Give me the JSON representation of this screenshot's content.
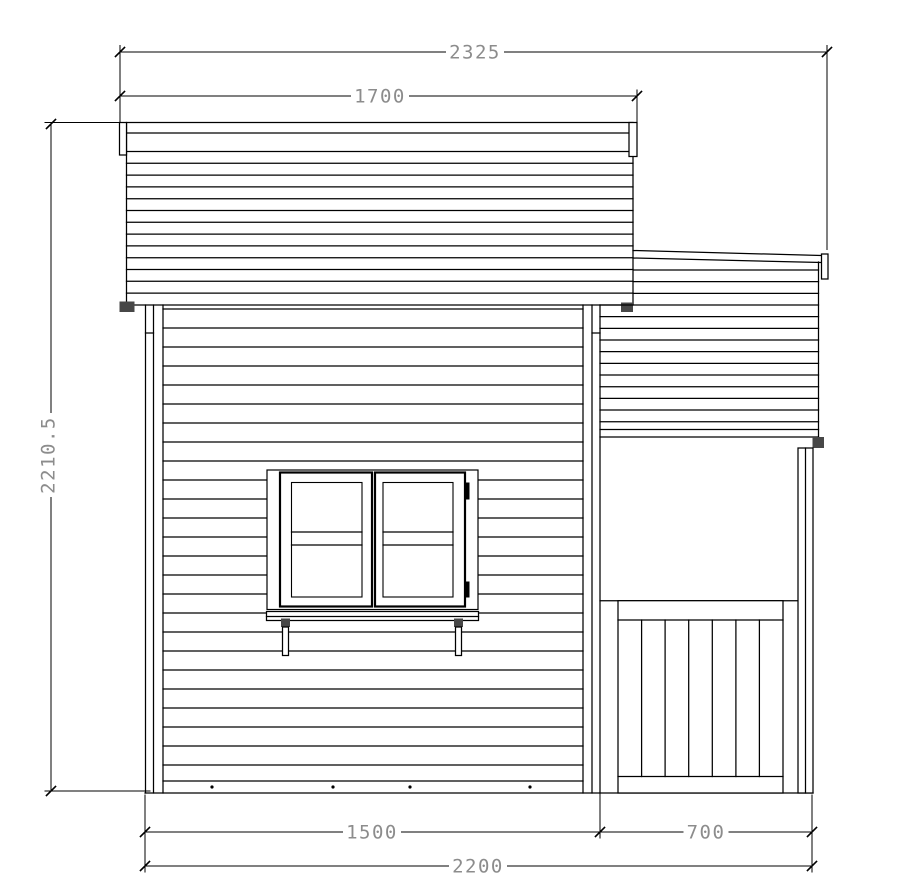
{
  "drawing": {
    "description": "playhouse-side-elevation",
    "canvas": {
      "w": 921,
      "h": 891,
      "background": "#ffffff",
      "line_color": "#000000",
      "dim_text_color": "#8c8c8c",
      "hatch_color": "#474747"
    },
    "groups": [
      {
        "name": "main-roof",
        "prims": [
          {
            "t": "r",
            "n": "main-roof-panel",
            "p": [
              126.5,
              122.5,
              506.5,
              182.5
            ]
          },
          {
            "t": "l",
            "n": "main-roof-fascia-line",
            "p": [
              126.5,
              133,
              633,
              133
            ]
          },
          {
            "t": "hl",
            "n": "main-roof-board-line",
            "y0": 151.5,
            "step": 11.8,
            "count": 13,
            "x1": 126.5,
            "x2": 633
          },
          {
            "t": "r",
            "n": "main-roof-left-trim",
            "p": [
              119.5,
              122.5,
              7,
              32.5
            ]
          },
          {
            "t": "r",
            "n": "main-roof-right-trim",
            "p": [
              629,
              122.5,
              8,
              34
            ]
          },
          {
            "t": "h",
            "n": "roof-eave-block-left",
            "p": [
              119.5,
              301.5,
              15,
              10.5
            ]
          },
          {
            "t": "h",
            "n": "roof-eave-block-right",
            "p": [
              621,
              302.5,
              12,
              9.5
            ]
          }
        ]
      },
      {
        "name": "porch-roof",
        "prims": [
          {
            "t": "l",
            "n": "porch-roof-top-edge",
            "p": [
              633,
              250.5,
              821,
              255.5
            ]
          },
          {
            "t": "l",
            "n": "porch-roof-fascia-line",
            "p": [
              633,
              258,
              821,
              262.5
            ]
          },
          {
            "t": "l",
            "n": "porch-roof-right-edge",
            "p": [
              818.5,
              262,
              818.5,
              437
            ]
          },
          {
            "t": "hl",
            "n": "porch-roof-board-line",
            "y0": 270,
            "step": 11.67,
            "count": 3,
            "x1": 633.5,
            "x2": 818.5
          },
          {
            "t": "hl",
            "n": "porch-roof-board-line",
            "y0": 305,
            "step": 11.67,
            "count": 11,
            "x1": 600,
            "x2": 818.5
          },
          {
            "t": "l",
            "n": "porch-roof-band-line",
            "p": [
              600,
              429.5,
              818.5,
              429.5
            ]
          },
          {
            "t": "l",
            "n": "porch-roof-bottom-edge",
            "p": [
              600,
              437,
              818.5,
              437
            ]
          },
          {
            "t": "r",
            "n": "porch-roof-right-trim",
            "p": [
              821.5,
              254,
              6.5,
              25
            ]
          },
          {
            "t": "h",
            "n": "porch-roof-corner-block",
            "p": [
              812.5,
              437,
              11.5,
              11
            ]
          }
        ]
      },
      {
        "name": "main-wall",
        "prims": [
          {
            "t": "l",
            "n": "left-corner-trim-outer",
            "p": [
              145.5,
              305,
              145.5,
              793
            ]
          },
          {
            "t": "l",
            "n": "left-corner-trim-inner",
            "p": [
              153.5,
              305,
              153.5,
              793
            ]
          },
          {
            "t": "l",
            "n": "left-corner-trim-edge",
            "p": [
              163,
              305,
              163,
              793
            ]
          },
          {
            "t": "l",
            "n": "left-corner-plate-tick",
            "p": [
              145.5,
              333,
              153.5,
              333
            ]
          },
          {
            "t": "l",
            "n": "right-corner-trim-edge",
            "p": [
              583,
              305,
              583,
              793
            ]
          },
          {
            "t": "l",
            "n": "right-corner-trim-inner",
            "p": [
              592,
              305,
              592,
              793
            ]
          },
          {
            "t": "l",
            "n": "right-corner-trim-outer",
            "p": [
              600,
              305,
              600,
              793
            ]
          },
          {
            "t": "l",
            "n": "right-corner-plate-tick",
            "p": [
              592,
              333,
              600,
              333
            ]
          },
          {
            "t": "hl",
            "n": "wall-siding-board-line",
            "y0": 309,
            "step": 19,
            "count": 24,
            "x1": 163,
            "x2": 583
          },
          {
            "t": "l",
            "n": "skirt-top-line",
            "p": [
              163,
              765,
              583,
              765
            ]
          },
          {
            "t": "l",
            "n": "skirt-mid-line",
            "p": [
              163,
              781,
              583,
              781
            ]
          },
          {
            "t": "l",
            "n": "ground-line",
            "p": [
              145,
              793,
              813,
              793
            ]
          },
          {
            "t": "d",
            "n": "skirt-fixing-dot",
            "p": [
              212,
              787
            ]
          },
          {
            "t": "d",
            "n": "skirt-fixing-dot",
            "p": [
              333,
              787
            ]
          },
          {
            "t": "d",
            "n": "skirt-fixing-dot",
            "p": [
              410,
              787
            ]
          },
          {
            "t": "d",
            "n": "skirt-fixing-dot",
            "p": [
              530,
              787
            ]
          }
        ]
      },
      {
        "name": "window",
        "prims": [
          {
            "t": "r",
            "n": "window-frame",
            "p": [
              267,
              470,
              211,
              139.5
            ],
            "w": 1.2
          },
          {
            "t": "r",
            "n": "window-left-sash",
            "p": [
              280,
              472.5,
              92,
              134
            ],
            "w": 2.2
          },
          {
            "t": "r",
            "n": "window-left-glass",
            "p": [
              291.5,
              482.5,
              70.5,
              114.5
            ],
            "w": 1.1
          },
          {
            "t": "l",
            "n": "window-left-midrail-top",
            "p": [
              291.5,
              532,
              362,
              532
            ]
          },
          {
            "t": "l",
            "n": "window-left-midrail-bottom",
            "p": [
              291.5,
              545,
              362,
              545
            ]
          },
          {
            "t": "r",
            "n": "window-right-sash",
            "p": [
              375,
              472.5,
              90,
              134
            ],
            "w": 2.2
          },
          {
            "t": "r",
            "n": "window-right-glass",
            "p": [
              383,
              482.5,
              70,
              114.5
            ],
            "w": 1.1
          },
          {
            "t": "l",
            "n": "window-right-midrail-top",
            "p": [
              383,
              532,
              453,
              532
            ]
          },
          {
            "t": "l",
            "n": "window-right-midrail-bottom",
            "p": [
              383,
              545,
              453,
              545
            ]
          },
          {
            "t": "f",
            "n": "window-hinge-top",
            "p": [
              464,
              482.5,
              5.5,
              17
            ]
          },
          {
            "t": "f",
            "n": "window-hinge-bottom",
            "p": [
              464,
              581.5,
              5.5,
              16
            ]
          }
        ]
      },
      {
        "name": "flower-box",
        "prims": [
          {
            "t": "r",
            "n": "flower-box-shelf",
            "p": [
              266.5,
              611.5,
              212,
              9
            ]
          },
          {
            "t": "l",
            "n": "flower-box-shelf-line",
            "p": [
              266.5,
              616.5,
              478.5,
              616.5
            ]
          },
          {
            "t": "h",
            "n": "flower-box-block-left",
            "p": [
              281,
              618.5,
              9,
              8.5
            ]
          },
          {
            "t": "h",
            "n": "flower-box-block-right",
            "p": [
              454,
              618.5,
              9,
              8.5
            ]
          },
          {
            "t": "r",
            "n": "flower-box-bracket-left",
            "p": [
              282.5,
              627,
              6,
              28.5
            ]
          },
          {
            "t": "r",
            "n": "flower-box-bracket-right",
            "p": [
              455.5,
              627,
              6,
              28.5
            ]
          }
        ]
      },
      {
        "name": "porch",
        "prims": [
          {
            "t": "l",
            "n": "porch-opening-top-line",
            "p": [
              600,
              600.7,
              798,
              600.7
            ]
          },
          {
            "t": "r",
            "n": "railing-panel",
            "p": [
              618,
              600.7,
              165,
              192.3
            ]
          },
          {
            "t": "l",
            "n": "railing-top-rail-line",
            "p": [
              618,
              620,
              783,
              620
            ]
          },
          {
            "t": "l",
            "n": "railing-bottom-rail-line",
            "p": [
              618,
              776.5,
              783,
              776.5
            ]
          },
          {
            "t": "vls",
            "n": "railing-slat-divider",
            "xs": [
              641.6,
              665.1,
              688.7,
              712.3,
              735.9,
              759.4
            ],
            "y1": 620,
            "y2": 776.5
          },
          {
            "t": "r",
            "n": "porch-post",
            "p": [
              798,
              448,
              15,
              345
            ]
          },
          {
            "t": "l",
            "n": "porch-post-inner-line",
            "p": [
              805.5,
              448,
              805.5,
              793
            ]
          }
        ]
      }
    ],
    "extension_lines": [
      [
        120,
        45.5,
        120,
        122.5
      ],
      [
        827,
        45.5,
        827,
        249.5
      ],
      [
        637,
        90,
        637,
        156.5
      ],
      [
        45,
        122.5,
        126.5,
        122.5
      ],
      [
        45,
        791,
        150,
        791
      ],
      [
        145,
        795,
        145,
        872
      ],
      [
        600,
        793,
        600,
        838
      ],
      [
        812,
        795,
        812,
        872
      ]
    ],
    "dims": [
      {
        "name": "dim-overall-width-top",
        "label": "2325",
        "dir": "h",
        "line": [
          120,
          52,
          827,
          52
        ],
        "text": [
          475,
          52
        ],
        "ticks": [
          [
            120,
            52
          ],
          [
            827,
            52
          ]
        ]
      },
      {
        "name": "dim-roof-width",
        "label": "1700",
        "dir": "h",
        "line": [
          120,
          96,
          637,
          96
        ],
        "text": [
          380,
          96
        ],
        "ticks": [
          [
            120,
            96
          ],
          [
            637,
            96
          ]
        ]
      },
      {
        "name": "dim-overall-height",
        "label": "2210.5",
        "dir": "v",
        "line": [
          51,
          124,
          51,
          791
        ],
        "text": [
          48,
          455
        ],
        "ticks": [
          [
            51,
            124
          ],
          [
            51,
            791
          ]
        ]
      },
      {
        "name": "dim-house-width",
        "label": "1500",
        "dir": "h",
        "line": [
          145,
          832,
          600,
          832
        ],
        "text": [
          372,
          832
        ],
        "ticks": [
          [
            145,
            832
          ],
          [
            600,
            832
          ]
        ]
      },
      {
        "name": "dim-porch-width",
        "label": "700",
        "dir": "h",
        "line": [
          600,
          832,
          812,
          832
        ],
        "text": [
          706,
          832
        ],
        "ticks": [
          [
            812,
            832
          ]
        ]
      },
      {
        "name": "dim-overall-width-bottom",
        "label": "2200",
        "dir": "h",
        "line": [
          145,
          866,
          812,
          866
        ],
        "text": [
          478,
          866
        ],
        "ticks": [
          [
            145,
            866
          ],
          [
            812,
            866
          ]
        ]
      }
    ]
  }
}
